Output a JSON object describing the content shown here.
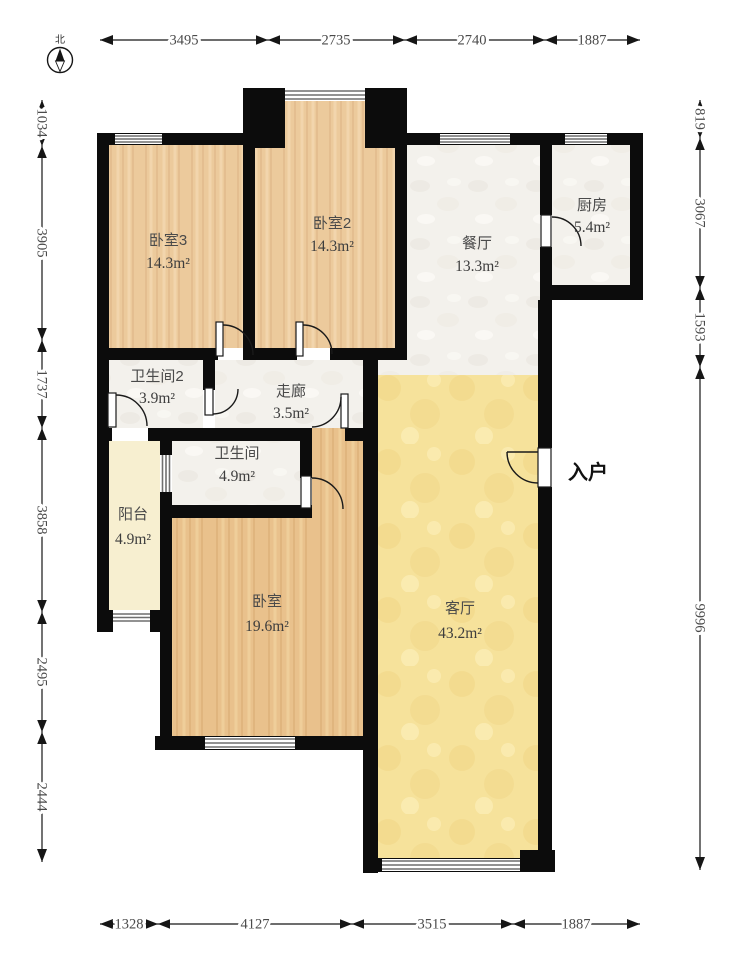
{
  "compass": {
    "label": "北"
  },
  "dims": {
    "top": [
      "3495",
      "2735",
      "2740",
      "1887"
    ],
    "left": [
      "1034",
      "3905",
      "1737",
      "3858",
      "2495",
      "2444"
    ],
    "right": [
      "819",
      "3067",
      "1593",
      "9996"
    ],
    "bottom": [
      "1328",
      "4127",
      "3515",
      "1887"
    ]
  },
  "rooms": {
    "bedroom3": {
      "name": "卧室3",
      "area": "14.3m²"
    },
    "bedroom2": {
      "name": "卧室2",
      "area": "14.3m²"
    },
    "dining": {
      "name": "餐厅",
      "area": "13.3m²"
    },
    "kitchen": {
      "name": "厨房",
      "area": "5.4m²"
    },
    "bath2": {
      "name": "卫生间2",
      "area": "3.9m²"
    },
    "corridor": {
      "name": "走廊",
      "area": "3.5m²"
    },
    "bath": {
      "name": "卫生间",
      "area": "4.9m²"
    },
    "balcony": {
      "name": "阳台",
      "area": "4.9m²"
    },
    "bedroom": {
      "name": "卧室",
      "area": "19.6m²"
    },
    "living": {
      "name": "客厅",
      "area": "43.2m²"
    }
  },
  "entrance": {
    "label": "入户"
  },
  "colors": {
    "wall": "#0c0c0c",
    "wood_floor": "#ecca9c",
    "wood_floor_dark": "#e9c18c",
    "tile_floor": "#f3f1ec",
    "living_floor": "#f6e29b",
    "balcony_floor": "#f7efd0",
    "dimension_text": "#4a4a4a"
  }
}
